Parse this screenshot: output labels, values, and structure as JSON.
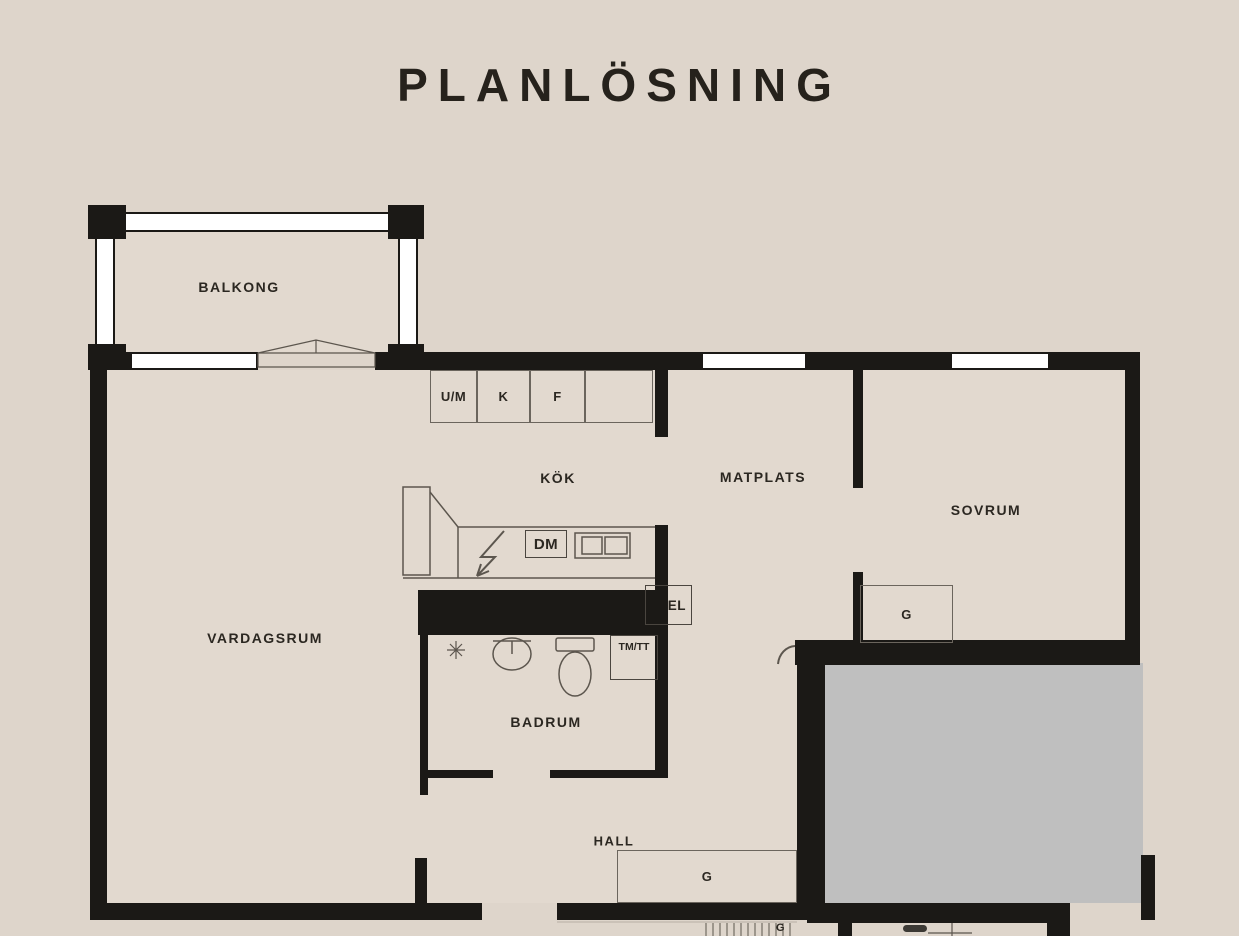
{
  "title": "PLANLÖSNING",
  "rooms": {
    "balkong": "BALKONG",
    "vardagsrum": "VARDAGSRUM",
    "kok": "KÖK",
    "matplats": "MATPLATS",
    "sovrum": "SOVRUM",
    "badrum": "BADRUM",
    "hall": "HALL"
  },
  "appliances": {
    "um": "U/M",
    "k": "K",
    "f": "F",
    "dm": "DM",
    "el": "EL",
    "tmtt": "TM/TT",
    "wardrobe_bedroom": "G",
    "wardrobe_hall": "G",
    "wardrobe_lower": "G"
  },
  "colors": {
    "background": "#ded5cb",
    "floor": "#e2d9cf",
    "wall": "#1b1916",
    "gray_area": "#bfbfbf",
    "window": "#ffffff",
    "text": "#2b2721",
    "outline": "#5c564e"
  }
}
